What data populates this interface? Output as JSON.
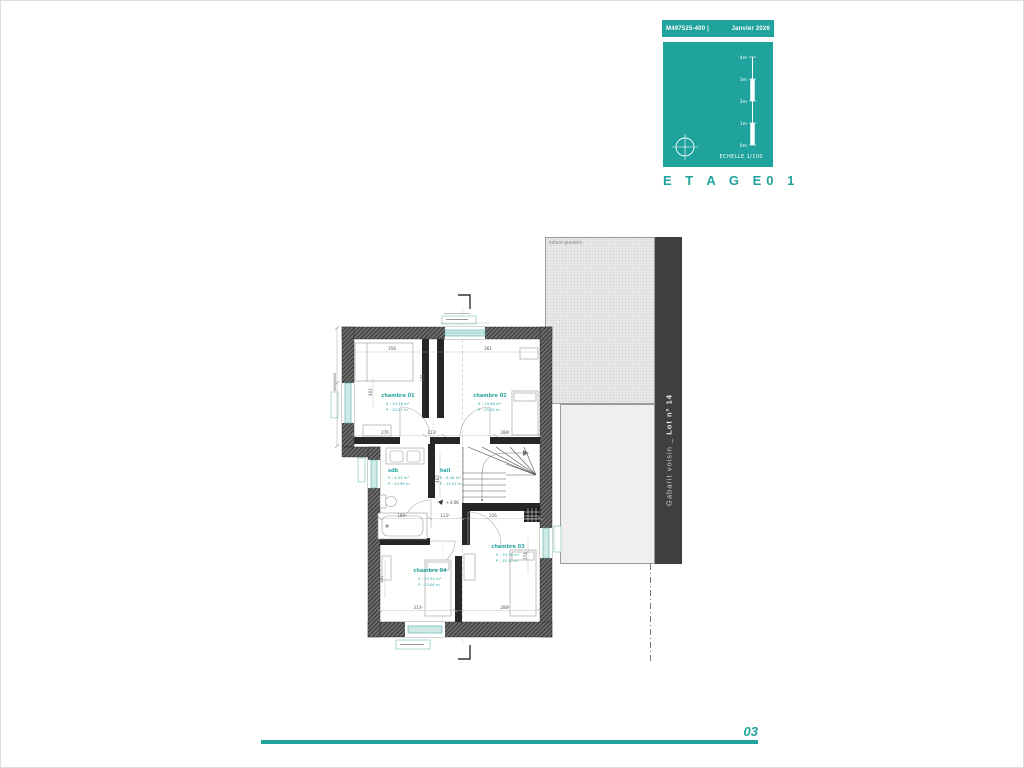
{
  "colors": {
    "teal": "#21a39d",
    "band": "#3f3f3f"
  },
  "titleblock": {
    "ref": "M497525-400",
    "sep": "|",
    "date": "Janvier 2026",
    "scale_ticks": [
      "4m",
      "3m",
      "2m",
      "1m",
      "0m"
    ],
    "scale_label": "ECHELLE  1/100",
    "title_left": "E T A G E",
    "title_right": "0 1"
  },
  "plan": {
    "level": "+3.06",
    "rooms": [
      {
        "name": "chambre 01",
        "surface": "S : 13.16 m²",
        "perimeter": "P : 13.27 m"
      },
      {
        "name": "chambre 02",
        "surface": "S : 13.66 m²",
        "perimeter": "P : 13.02 m"
      },
      {
        "name": "sdb",
        "surface": "S : 4.03 m²",
        "perimeter": "P : 10.99 m"
      },
      {
        "name": "hall",
        "surface": "S : 8.48 m²",
        "perimeter": "P : 12.47 m"
      },
      {
        "name": "chambre 03",
        "surface": "S : 10.76 m²",
        "perimeter": "P : 15.15 m"
      },
      {
        "name": "chambre 04",
        "surface": "S : 10.51 m²",
        "perimeter": "P : 13.06 m"
      }
    ],
    "dims": [
      "358",
      "361",
      "276",
      "401",
      "276",
      "113²",
      "288²",
      "462",
      "186²",
      "113²",
      "226",
      "307",
      "313²",
      "288²",
      "374"
    ]
  },
  "neighbor": {
    "roof_label": "toiture graviers",
    "band_text": "Gabarit voisin _ ",
    "band_lot": "Lot n° 14"
  },
  "footer": {
    "page": "03"
  }
}
